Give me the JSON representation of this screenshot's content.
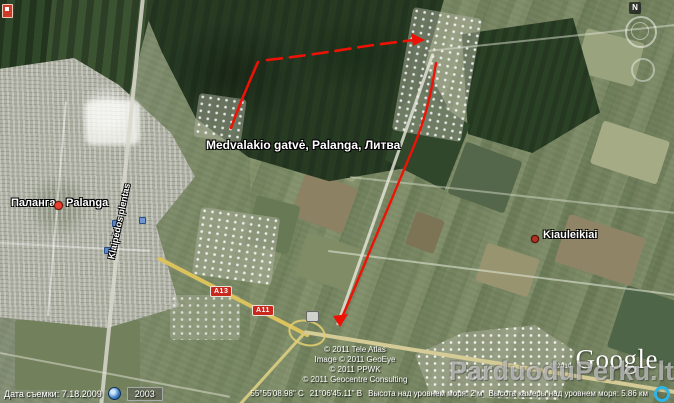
{
  "app": {
    "name": "Google Earth"
  },
  "map_labels": {
    "main_place": "Medvalakio gatvė, Palanga, Литва",
    "city_ru": "Паланга",
    "city_lt": "Palanga",
    "village": "Kiauleikiai",
    "road_vertical": "Klaipėdos plentas",
    "route_a13": "A13",
    "route_a11": "A11"
  },
  "compass": {
    "north_label": "N"
  },
  "watermark": {
    "text": "ParduoduPerku.lt"
  },
  "logo": {
    "small_copyright": "© 2010",
    "brand": "Google"
  },
  "attribution": {
    "lines": [
      "© 2011 Tele Atlas",
      "Image © 2011 GeoEye",
      "© 2011 PPWK",
      "© 2011 Geocentre Consulting"
    ]
  },
  "status_bar": {
    "imagery_date": "Дата съемки: 7.18.2009",
    "year_badge": "2003",
    "coordinates_lat": "55°55'08.98\" С",
    "coordinates_lon": "21°06'45.11\" В",
    "elevation": "Высота над уровнем моря: 2 м",
    "camera_altitude": "Высота камеры над уровнем моря: 5.86 км"
  },
  "icons": {
    "history_clock": "history-clock-icon",
    "streaming_indicator": "streaming-progress-icon",
    "compass_north": "compass-north-icon",
    "look_ring": "look-ring-icon",
    "pan_joystick": "pan-joystick-icon",
    "city_placemark": "red-dot-placemark-icon",
    "village_placemark": "dark-red-dot-placemark-icon"
  },
  "colors": {
    "route_red": "#ee1206",
    "shield_red": "#c9281c",
    "road_yellow": "#dcc25c",
    "placemark_red": "#e8402e",
    "streaming_blue": "#2fb4e8",
    "label_white": "#ffffff"
  }
}
